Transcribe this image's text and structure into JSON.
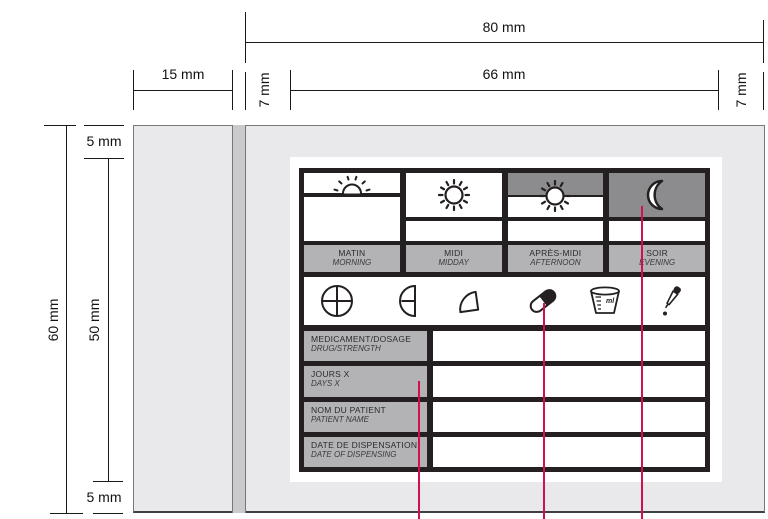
{
  "diagram_title": "medication-label-dimension-specification",
  "dimensions": {
    "total_width": "80 mm",
    "liner_tab_width": "15 mm",
    "left_margin": "7 mm",
    "print_area_width": "66 mm",
    "right_margin": "7 mm",
    "total_height": "60 mm",
    "print_area_height": "50 mm",
    "top_margin": "5 mm",
    "bottom_margin": "5 mm"
  },
  "label": {
    "time_columns": [
      {
        "icon": "sunrise-icon",
        "fr": "MATIN",
        "en": "MORNING"
      },
      {
        "icon": "sun-icon",
        "fr": "MIDI",
        "en": "MIDDAY"
      },
      {
        "icon": "sunset-icon",
        "fr": "APRÈS-MIDI",
        "en": "AFTERNOON"
      },
      {
        "icon": "moon-icon",
        "fr": "SOIR",
        "en": "EVENING"
      }
    ],
    "dose_icons": [
      "tablet-whole-icon",
      "tablet-half-icon",
      "tablet-quarter-icon",
      "capsule-icon",
      "measuring-cup-icon",
      "dropper-icon"
    ],
    "measuring_cup_text": "ml",
    "field_rows": [
      {
        "fr": "MEDICAMENT/DOSAGE",
        "en": "DRUG/STRENGTH",
        "value": ""
      },
      {
        "fr": "JOURS X",
        "en": "DAYS X",
        "value": ""
      },
      {
        "fr": "NOM DU PATIENT",
        "en": "PATIENT NAME",
        "value": ""
      },
      {
        "fr": "DATE DE DISPENSATION",
        "en": "DATE OF DISPENSING",
        "value": ""
      }
    ]
  },
  "colors": {
    "grid_black": "#242021",
    "night_gray": "#8c8c8e",
    "label_gray": "#b3b3b5",
    "liner_gray": "#e9e9eb",
    "liner_strip_gray": "#cacacc",
    "callout_red": "#d40f50"
  }
}
